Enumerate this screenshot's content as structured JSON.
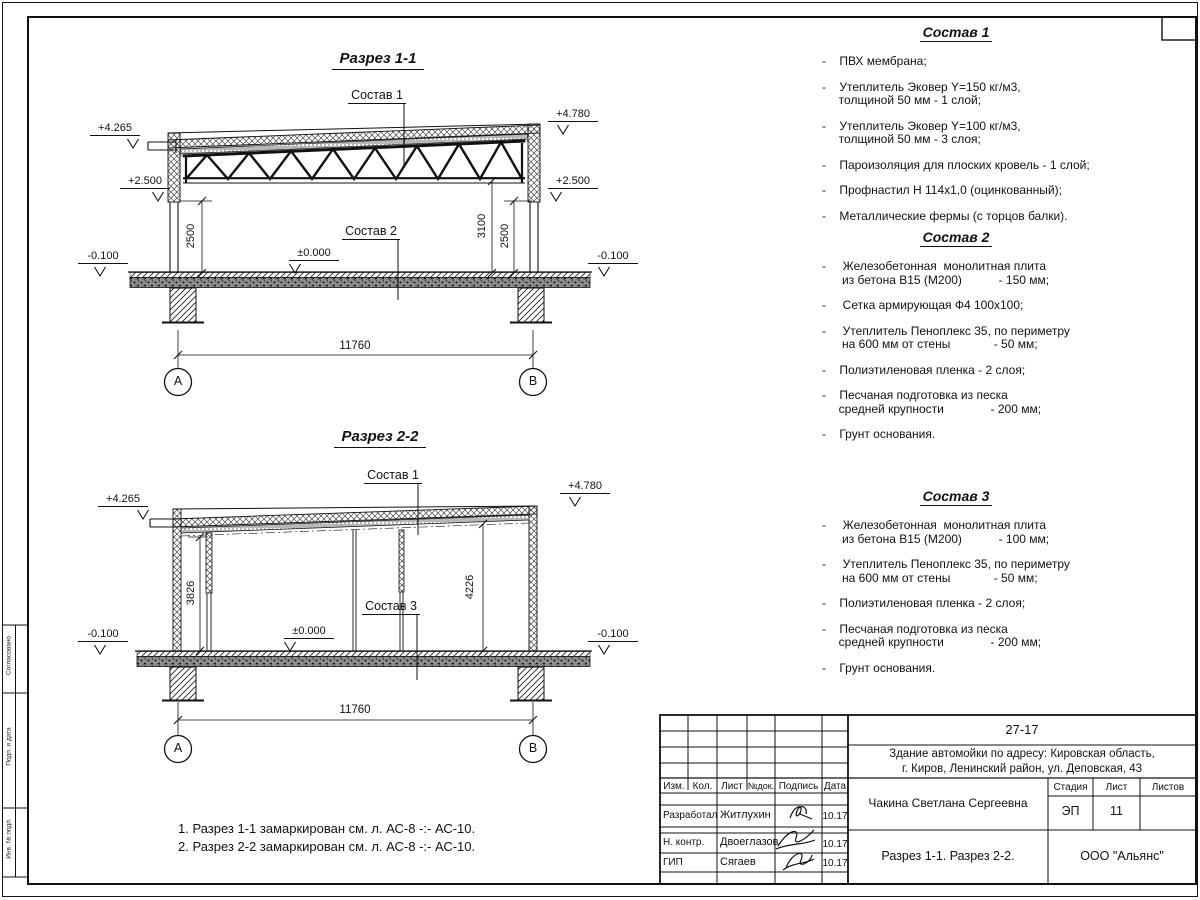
{
  "s1": {
    "title": "Разрез 1-1",
    "callout_top": "Состав 1",
    "callout_floor": "Состав 2",
    "elev": {
      "tl": "+4.265",
      "tr": "+4.780",
      "ml": "+2.500",
      "mr": "+2.500",
      "zero": "±0.000",
      "bl": "-0.100",
      "br": "-0.100"
    },
    "dims": {
      "left": "2500",
      "right_inner": "3100",
      "right_outer": "2500",
      "span": "11760"
    },
    "axes": {
      "a": "А",
      "b": "В"
    }
  },
  "s2": {
    "title": "Разрез 2-2",
    "callout_top": "Состав 1",
    "callout_floor": "Состав 3",
    "elev": {
      "tl": "+4.265",
      "tr": "+4.780",
      "zero": "±0.000",
      "bl": "-0.100",
      "br": "-0.100"
    },
    "dims": {
      "left": "3826",
      "right": "4226",
      "span": "11760"
    },
    "axes": {
      "a": "А",
      "b": "В"
    }
  },
  "notes": "1. Разрез 1-1 замаркирован см. л. АС-8 -:- АС-10.\n2. Разрез 2-2 замаркирован см. л. АС-8 -:- АС-10.",
  "compositions": [
    {
      "title": "Состав 1",
      "items": [
        "-    ПВХ мембрана;",
        "-    Утеплитель Эковер Y=150 кг/м3,\n     толщиной 50 мм - 1 слой;",
        "-    Утеплитель Эковер Y=100 кг/м3,\n     толщиной 50 мм - 3 слоя;",
        "-    Пароизоляция для плоских кровель - 1 слой;",
        "-    Профнастил Н 114х1,0 (оцинкованный);",
        "-    Металлические фермы (с торцов балки)."
      ]
    },
    {
      "title": "Состав 2",
      "items": [
        "-     Железобетонная  монолитная плита\n      из бетона В15 (М200)           - 150 мм;",
        "-     Сетка армирующая Ф4 100х100;",
        "-     Утеплитель Пеноплекс 35, по периметру\n      на 600 мм от стены             - 50 мм;",
        "-    Полиэтиленовая пленка - 2 слоя;",
        "-    Песчаная подготовка из песка\n     средней крупности              - 200 мм;",
        "-    Грунт основания."
      ]
    },
    {
      "title": "Состав 3",
      "items": [
        "-     Железобетонная  монолитная плита\n      из бетона В15 (М200)           - 100 мм;",
        "-     Утеплитель Пеноплекс 35, по периметру\n      на 600 мм от стены             - 50 мм;",
        "-    Полиэтиленовая пленка - 2 слоя;",
        "-    Песчаная подготовка из песка\n     средней крупности              - 200 мм;",
        "-    Грунт основания."
      ]
    }
  ],
  "titleblock": {
    "doc_number": "27-17",
    "project": "Здание автомойки по адресу: Кировская область,\nг. Киров, Ленинский район, ул. Деповская, 43",
    "cols": {
      "izm": "Изм.",
      "kol": "Кол.",
      "list": "Лист",
      "ndok": "№док.",
      "podpis": "Подпись",
      "data": "Дата"
    },
    "rows": [
      {
        "role": "Разработал",
        "name": "Житлухин",
        "date": "10.17"
      },
      {
        "role": "Н. контр.",
        "name": "Двоеглазов",
        "date": "10.17"
      },
      {
        "role": "ГИП",
        "name": "Сягаев",
        "date": "10.17"
      }
    ],
    "author": "Чакина Светлана Сергеевна",
    "sheet_title": "Разрез 1-1. Разрез 2-2.",
    "stage_label": "Стадия",
    "sheet_label": "Лист",
    "sheets_label": "Листов",
    "stage": "ЭП",
    "sheet_no": "11",
    "sheets_total": "",
    "company": "ООО \"Альянс\""
  },
  "margin_labels": [
    "Согласовано",
    "Подп. и дата",
    "Инв. № подл."
  ]
}
